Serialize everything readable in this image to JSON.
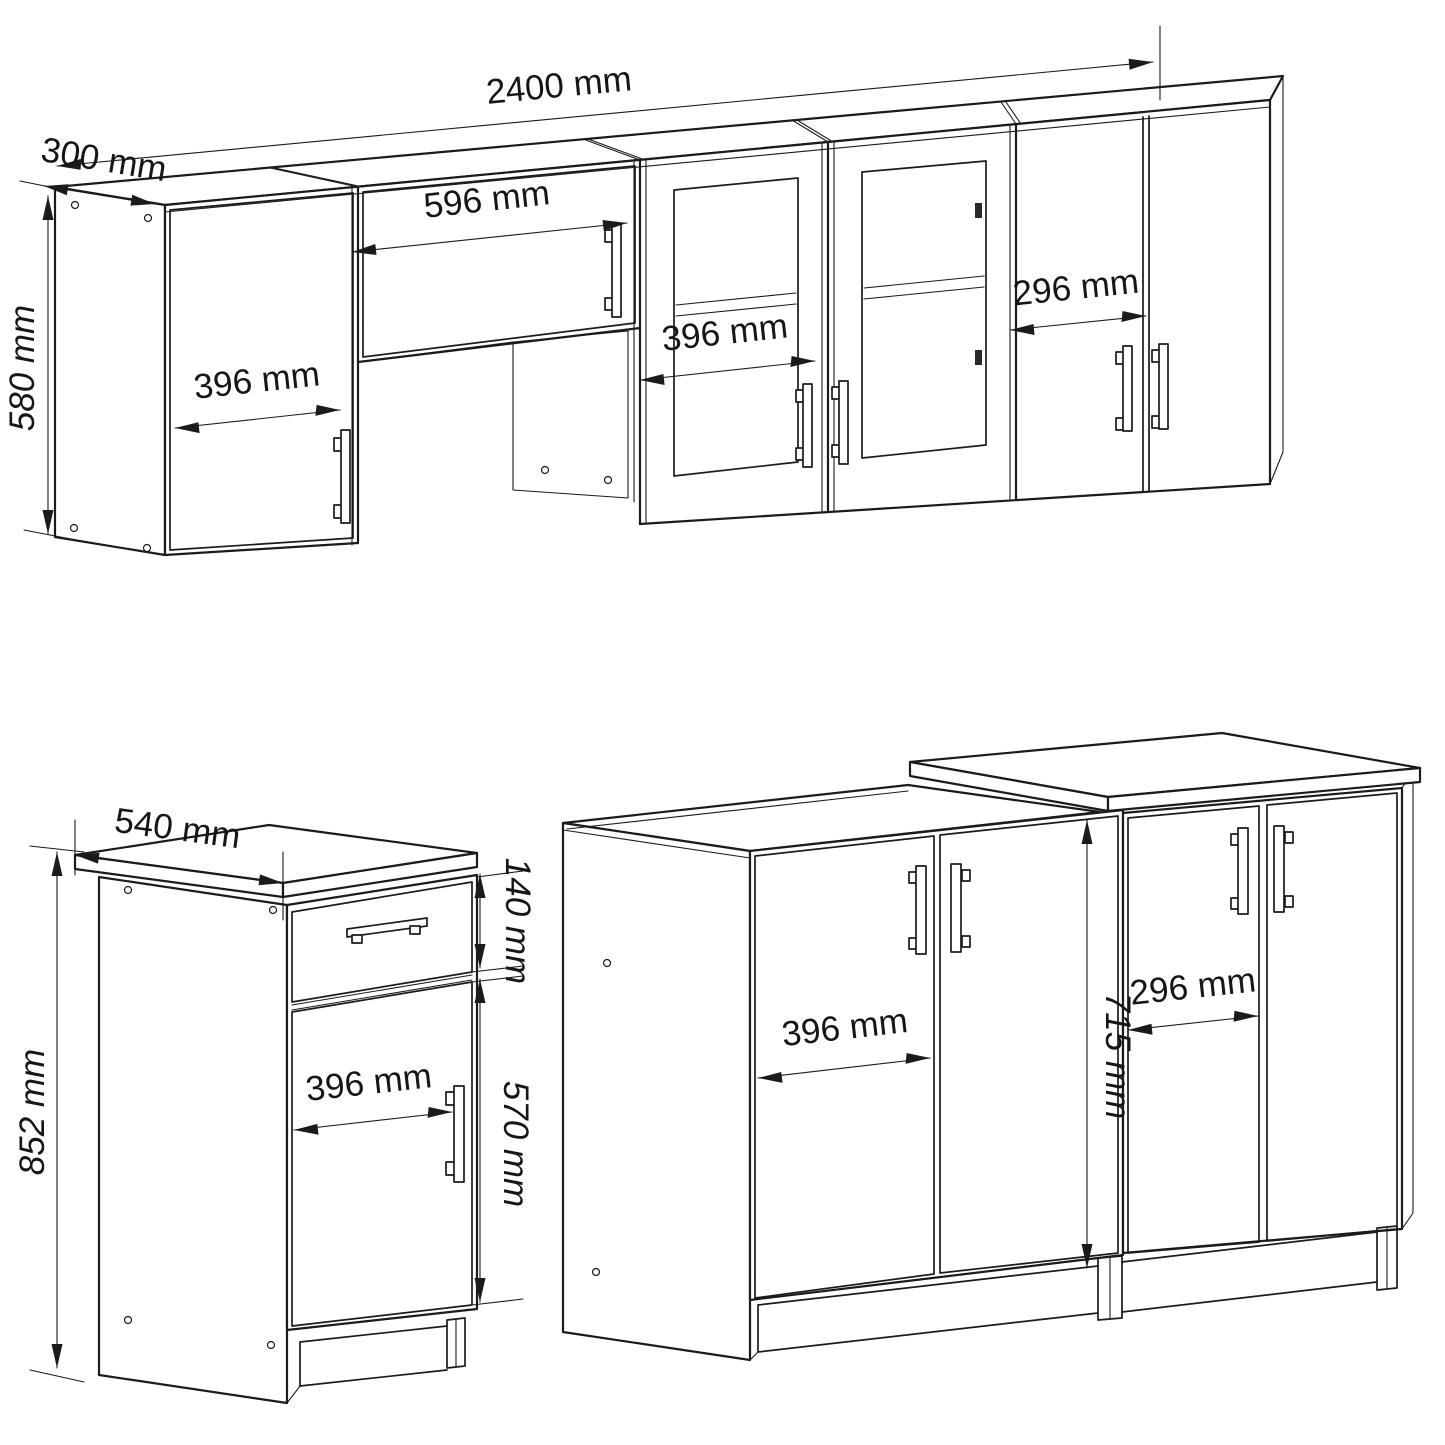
{
  "units": "mm",
  "colors": {
    "background": "#ffffff",
    "line": "#1b1b1b",
    "text": "#161616"
  },
  "wall_assembly": {
    "total_width": "2400 mm",
    "depth": "300 mm",
    "height": "580 mm",
    "left_door_width": "396 mm",
    "flap_door_width": "596 mm",
    "glass_door_width": "396 mm",
    "right_door_width": "296 mm"
  },
  "base_cabinet": {
    "worktop_depth": "540 mm",
    "height": "852 mm",
    "drawer_front_height": "140 mm",
    "door_width": "396 mm",
    "door_height": "570 mm"
  },
  "corner_base_group": {
    "left_door_width": "396 mm",
    "door_height": "715 mm",
    "right_door_width": "296 mm"
  }
}
